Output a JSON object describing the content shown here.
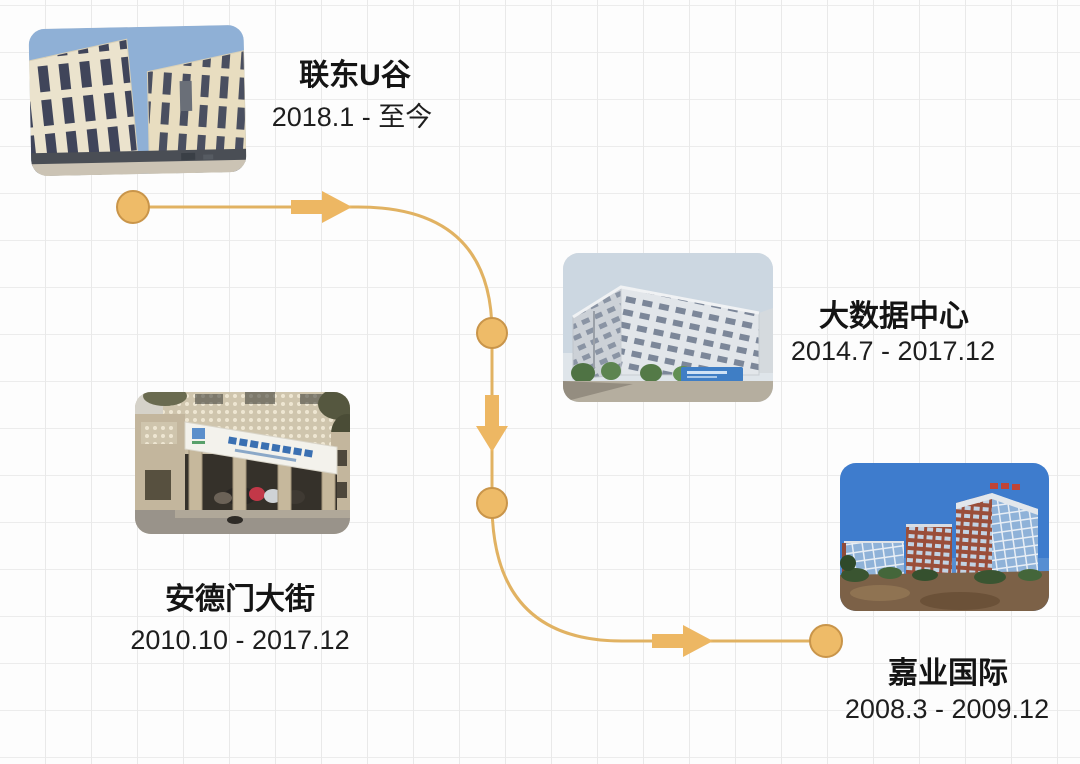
{
  "colors": {
    "accent_fill": "#EEBB68",
    "accent_border": "#C9954A",
    "connector_line": "#E1B262",
    "text": "#141414",
    "grid_line": "#E9E9E9",
    "background": "#FDFDFD"
  },
  "timeline": {
    "items": [
      {
        "id": "liandong-u-valley",
        "title": "联东U谷",
        "period": "2018.1 - 至今"
      },
      {
        "id": "big-data-center",
        "title": "大数据中心",
        "period": "2014.7 - 2017.12"
      },
      {
        "id": "andemen-street",
        "title": "安德门大街",
        "period": "2010.10 - 2017.12"
      },
      {
        "id": "jiaye-international",
        "title": "嘉业国际",
        "period": "2008.3 - 2009.12"
      }
    ]
  }
}
